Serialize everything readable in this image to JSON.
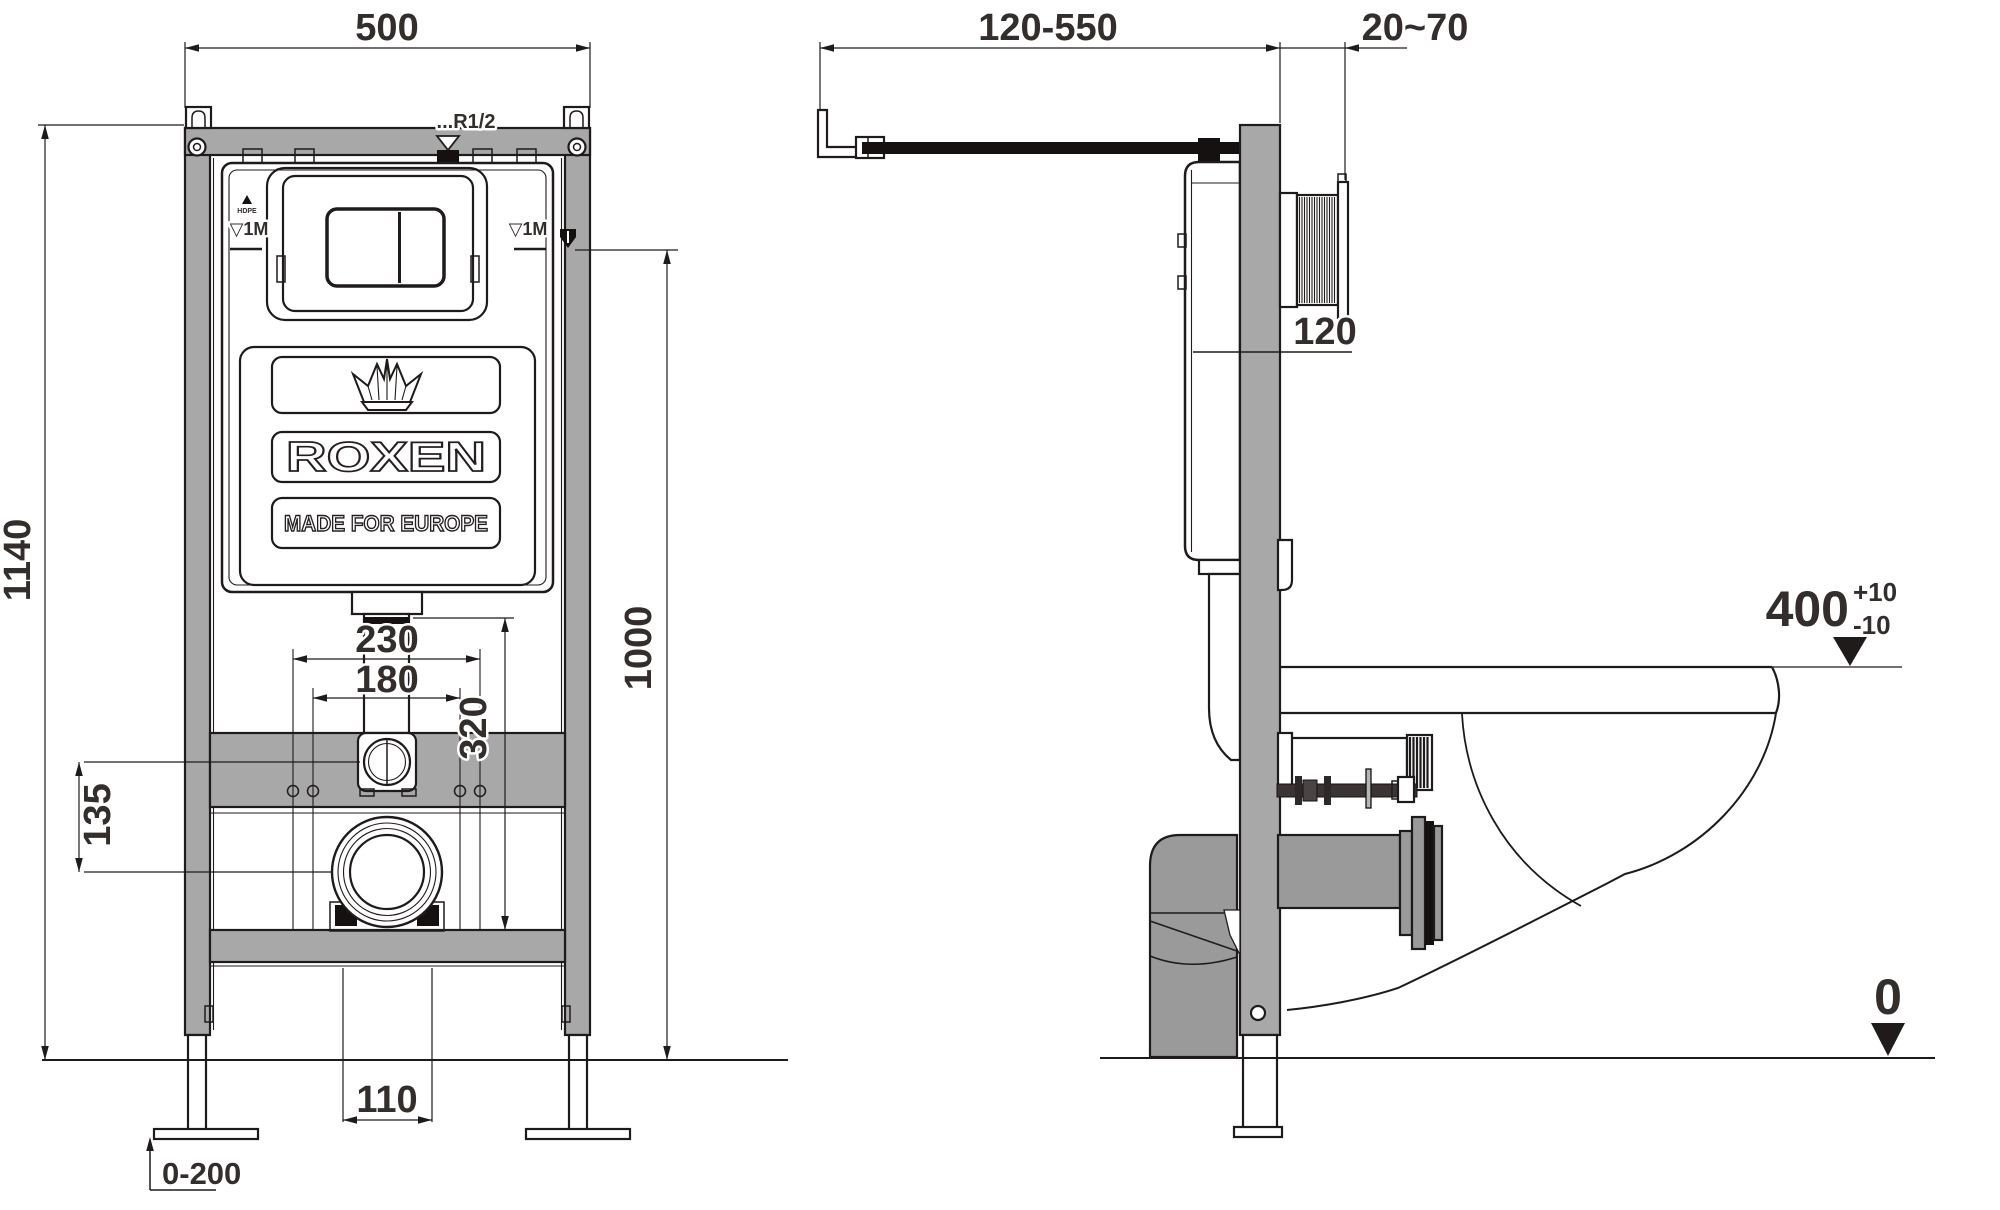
{
  "title": "Wall-hung WC installation frame technical drawing",
  "front_view": {
    "brand": {
      "name": "ROXEN",
      "tagline": "MADE FOR EUROPE",
      "emblem": "HDPE"
    },
    "labels": {
      "inlet_thread": "...R1/2",
      "level_left": "▽1M",
      "level_right": "▽1M"
    },
    "dims": {
      "overall_width": "500",
      "overall_height": "1140",
      "inlet_height": "1000",
      "fixing_outer": "230",
      "fixing_inner": "180",
      "offset_outlet": "135",
      "outlet_height": "320",
      "waste_width": "110",
      "leg_adjustment": "0-200"
    }
  },
  "side_view": {
    "dims": {
      "wall_distance": "120-550",
      "finish_gap": "20~70",
      "frame_depth": "120",
      "bowl_height": "400",
      "tolerance_plus": "+10",
      "tolerance_minus": "-10",
      "floor_level": "0"
    }
  },
  "colors": {
    "frame_gray": "#a8a8a8",
    "pipe_gray": "#9a9a9a",
    "line": "#1f1b1a",
    "text": "#332d2b",
    "background": "#ffffff"
  }
}
